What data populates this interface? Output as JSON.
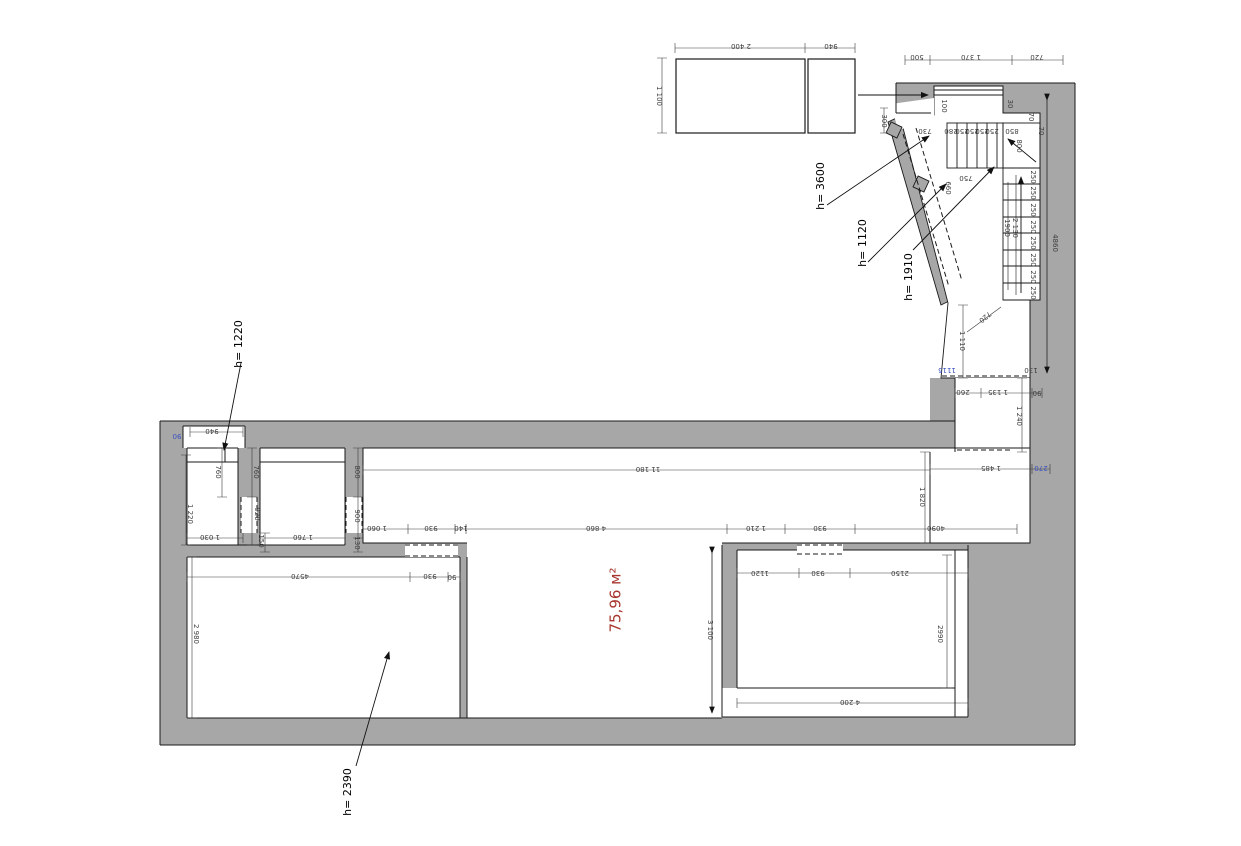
{
  "drawing": {
    "type": "floor-plan",
    "area_label": "75,96 м²",
    "colors": {
      "wall_gray": "#a7a7a7",
      "line_black": "#1a1a1a",
      "dim_text": "#3d3d3d",
      "area_red": "#a8362e",
      "highlight_blue": "#3a4fc1"
    },
    "height_notes": [
      "h= 3600",
      "h= 1120",
      "h= 1910",
      "h= 1220",
      "h= 2390"
    ],
    "labels": [
      {
        "t": "2 400",
        "x": 741,
        "y": 46,
        "r": 180
      },
      {
        "t": "940",
        "x": 831,
        "y": 46,
        "r": 180
      },
      {
        "t": "1 100",
        "x": 659,
        "y": 96,
        "r": 90
      },
      {
        "t": "500",
        "x": 917,
        "y": 57,
        "r": 180
      },
      {
        "t": "1 370",
        "x": 971,
        "y": 57,
        "r": 180
      },
      {
        "t": "720",
        "x": 1037,
        "y": 57,
        "r": 180
      },
      {
        "t": "100",
        "x": 944,
        "y": 106,
        "r": 90
      },
      {
        "t": "30",
        "x": 1010,
        "y": 104,
        "r": 90
      },
      {
        "t": "70",
        "x": 1031,
        "y": 117,
        "r": 90
      },
      {
        "t": "300",
        "x": 884,
        "y": 121,
        "r": 90
      },
      {
        "t": "730",
        "x": 925,
        "y": 131,
        "r": 180
      },
      {
        "t": "280",
        "x": 951,
        "y": 131,
        "r": 180
      },
      {
        "t": "250",
        "x": 962,
        "y": 131,
        "r": 180
      },
      {
        "t": "250",
        "x": 972,
        "y": 131,
        "r": 180
      },
      {
        "t": "250",
        "x": 982,
        "y": 131,
        "r": 180
      },
      {
        "t": "250",
        "x": 992,
        "y": 131,
        "r": 180
      },
      {
        "t": "850",
        "x": 1012,
        "y": 131,
        "r": 180
      },
      {
        "t": "800",
        "x": 1019,
        "y": 146,
        "r": 90
      },
      {
        "t": "70",
        "x": 1041,
        "y": 131,
        "r": 90
      },
      {
        "t": "660",
        "x": 948,
        "y": 188,
        "r": 90
      },
      {
        "t": "750",
        "x": 966,
        "y": 178,
        "r": 180
      },
      {
        "t": "250",
        "x": 1033,
        "y": 177,
        "r": 90
      },
      {
        "t": "250",
        "x": 1033,
        "y": 193,
        "r": 90
      },
      {
        "t": "250",
        "x": 1033,
        "y": 210,
        "r": 90
      },
      {
        "t": "250",
        "x": 1033,
        "y": 227,
        "r": 90
      },
      {
        "t": "250",
        "x": 1033,
        "y": 243,
        "r": 90
      },
      {
        "t": "250",
        "x": 1033,
        "y": 260,
        "r": 90
      },
      {
        "t": "250",
        "x": 1033,
        "y": 277,
        "r": 90
      },
      {
        "t": "250",
        "x": 1033,
        "y": 293,
        "r": 90
      },
      {
        "t": "1900",
        "x": 1007,
        "y": 228,
        "r": 90
      },
      {
        "t": "2 130",
        "x": 1015,
        "y": 228,
        "r": 90
      },
      {
        "t": "4860",
        "x": 1055,
        "y": 243,
        "r": 90
      },
      {
        "t": "720",
        "x": 985,
        "y": 317,
        "r": 140
      },
      {
        "t": "1 110",
        "x": 962,
        "y": 341,
        "r": 90
      },
      {
        "t": "1115",
        "x": 947,
        "y": 370,
        "r": 180,
        "c": "#3a4fc1"
      },
      {
        "t": "130",
        "x": 1031,
        "y": 370,
        "r": 180
      },
      {
        "t": "260",
        "x": 963,
        "y": 392,
        "r": 180
      },
      {
        "t": "1 135",
        "x": 998,
        "y": 392,
        "r": 180
      },
      {
        "t": "90",
        "x": 1037,
        "y": 393,
        "r": 180
      },
      {
        "t": "1 240",
        "x": 1019,
        "y": 416,
        "r": 90
      },
      {
        "t": "1 485",
        "x": 991,
        "y": 468,
        "r": 180
      },
      {
        "t": "270",
        "x": 1041,
        "y": 468,
        "r": 180,
        "c": "#3a4fc1"
      },
      {
        "t": "1 820",
        "x": 922,
        "y": 497,
        "r": 90
      },
      {
        "t": "11 180",
        "x": 648,
        "y": 469,
        "r": 180
      },
      {
        "t": "1 060",
        "x": 377,
        "y": 528,
        "r": 180
      },
      {
        "t": "930",
        "x": 431,
        "y": 528,
        "r": 180
      },
      {
        "t": "140",
        "x": 461,
        "y": 528,
        "r": 180
      },
      {
        "t": "4 860",
        "x": 596,
        "y": 528,
        "r": 180
      },
      {
        "t": "1 210",
        "x": 756,
        "y": 528,
        "r": 180
      },
      {
        "t": "930",
        "x": 820,
        "y": 528,
        "r": 180
      },
      {
        "t": "4090",
        "x": 936,
        "y": 528,
        "r": 180
      },
      {
        "t": "90",
        "x": 177,
        "y": 436,
        "r": 180,
        "c": "#3a4fc1"
      },
      {
        "t": "940",
        "x": 212,
        "y": 431,
        "r": 180
      },
      {
        "t": "760",
        "x": 218,
        "y": 472,
        "r": 90
      },
      {
        "t": "760",
        "x": 256,
        "y": 472,
        "r": 90
      },
      {
        "t": "1 220",
        "x": 190,
        "y": 514,
        "r": 90
      },
      {
        "t": "920",
        "x": 257,
        "y": 514,
        "r": 90
      },
      {
        "t": "1 030",
        "x": 210,
        "y": 537,
        "r": 180
      },
      {
        "t": "1 760",
        "x": 303,
        "y": 537,
        "r": 180
      },
      {
        "t": "150",
        "x": 261,
        "y": 541,
        "r": 90
      },
      {
        "t": "800",
        "x": 357,
        "y": 472,
        "r": 90
      },
      {
        "t": "900",
        "x": 357,
        "y": 516,
        "r": 90
      },
      {
        "t": "130",
        "x": 357,
        "y": 543,
        "r": 90
      },
      {
        "t": "4570",
        "x": 300,
        "y": 576,
        "r": 180
      },
      {
        "t": "930",
        "x": 430,
        "y": 576,
        "r": 180
      },
      {
        "t": "90",
        "x": 452,
        "y": 577,
        "r": 180
      },
      {
        "t": "2 980",
        "x": 196,
        "y": 634,
        "r": 90
      },
      {
        "t": "3 100",
        "x": 710,
        "y": 630,
        "r": 90
      },
      {
        "t": "1120",
        "x": 760,
        "y": 573,
        "r": 180
      },
      {
        "t": "930",
        "x": 818,
        "y": 573,
        "r": 180
      },
      {
        "t": "2150",
        "x": 900,
        "y": 573,
        "r": 180
      },
      {
        "t": "2990",
        "x": 940,
        "y": 634,
        "r": 90
      },
      {
        "t": "4 200",
        "x": 850,
        "y": 702,
        "r": 180
      },
      {
        "t": "75,96 м²",
        "x": 616,
        "y": 600,
        "r": 270,
        "c": "#a8362e",
        "s": 15
      },
      {
        "t": "h= 3600",
        "x": 821,
        "y": 186,
        "r": 270,
        "c": "#000000",
        "s": 11
      },
      {
        "t": "h= 1120",
        "x": 863,
        "y": 243,
        "r": 270,
        "c": "#000000",
        "s": 11
      },
      {
        "t": "h= 1910",
        "x": 909,
        "y": 277,
        "r": 270,
        "c": "#000000",
        "s": 11
      },
      {
        "t": "h= 1220",
        "x": 239,
        "y": 344,
        "r": 270,
        "c": "#000000",
        "s": 11
      },
      {
        "t": "h= 2390",
        "x": 348,
        "y": 792,
        "r": 270,
        "c": "#000000",
        "s": 11
      }
    ]
  }
}
